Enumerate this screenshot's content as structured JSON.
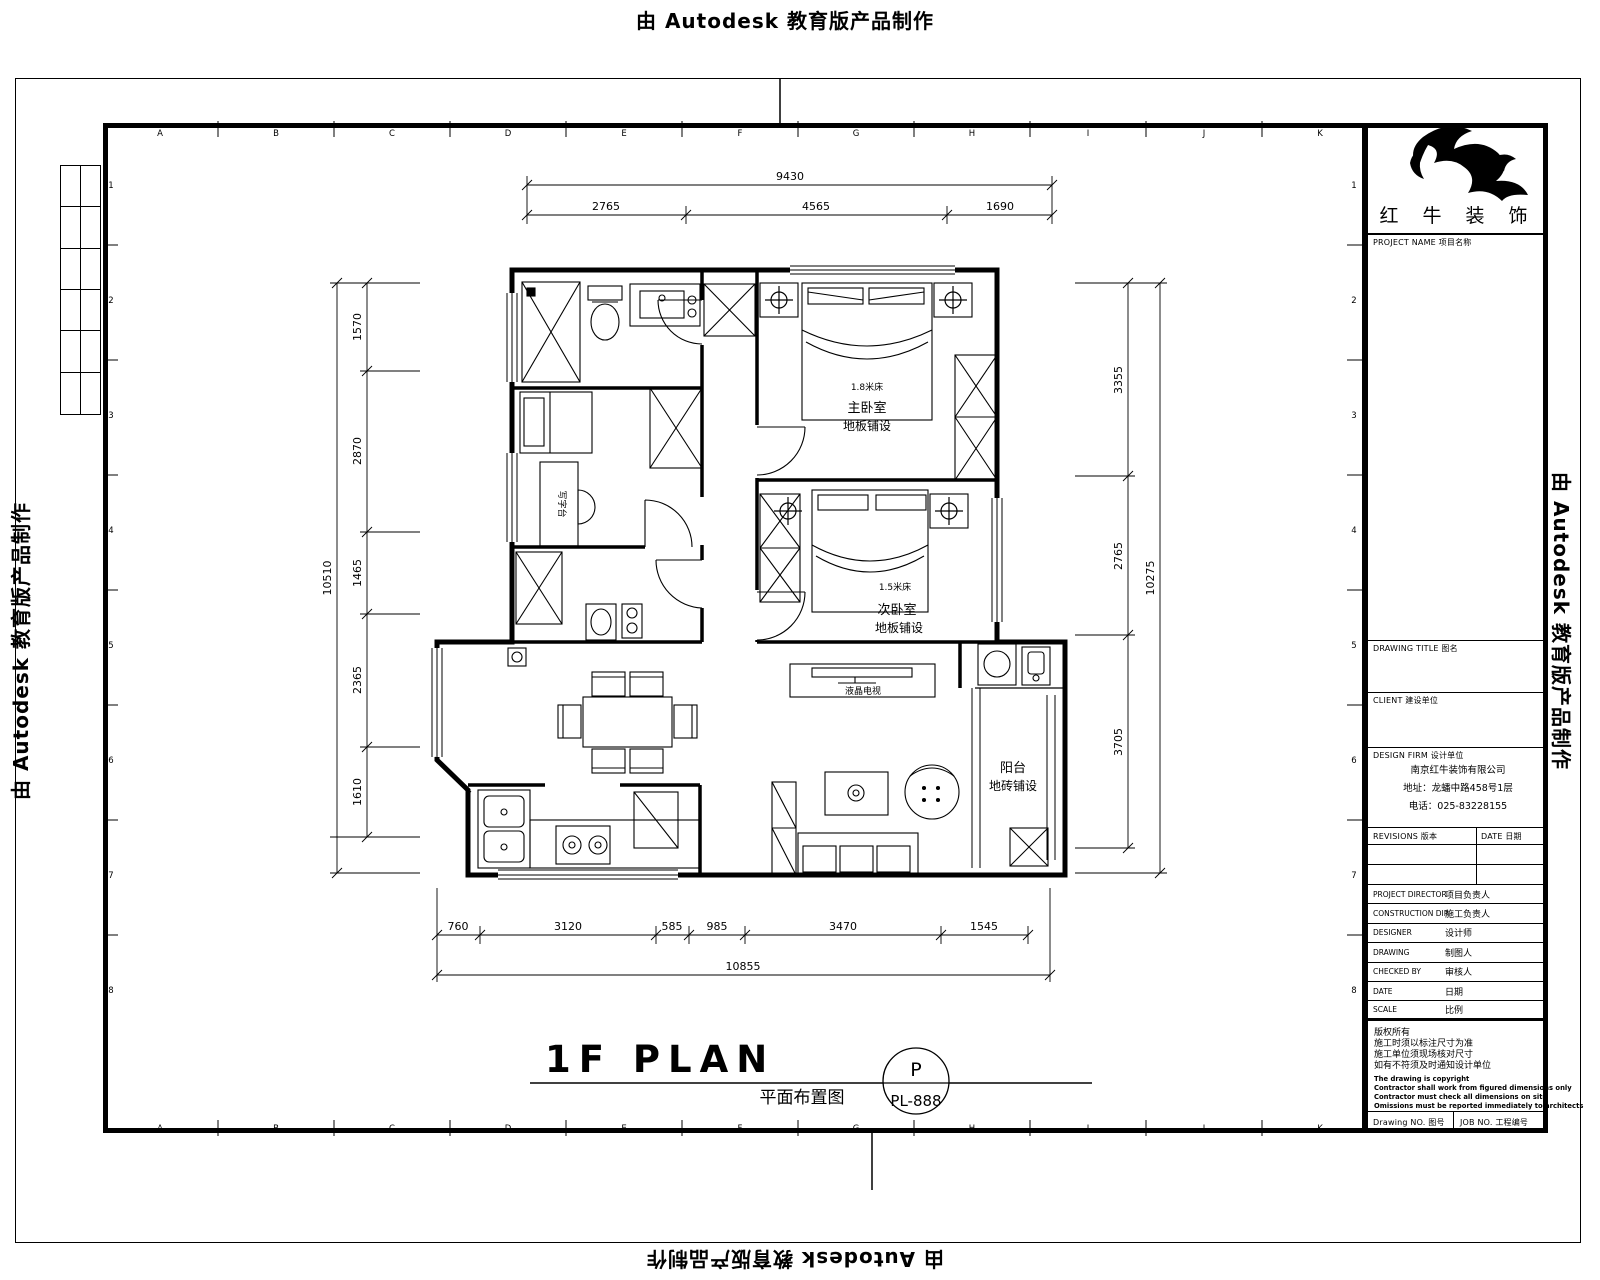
{
  "banner": {
    "text": "由 Autodesk 教育版产品制作"
  },
  "title": {
    "main": "1F PLAN",
    "subtitle": "平面布置图",
    "stamp_letter": "P",
    "stamp_number": "PL-888"
  },
  "grid": {
    "letters": [
      "A",
      "B",
      "C",
      "D",
      "E",
      "F",
      "G",
      "H",
      "I",
      "J",
      "K"
    ],
    "numbers": [
      "1",
      "2",
      "3",
      "4",
      "5",
      "6",
      "7",
      "8"
    ]
  },
  "dimensions": {
    "top": {
      "total": "9430",
      "segments": [
        "2765",
        "4565",
        "1690"
      ]
    },
    "left": {
      "total": "10510",
      "segments": [
        "1570",
        "2870",
        "1465",
        "2365",
        "1610"
      ]
    },
    "right": {
      "total": "10275",
      "segments": [
        "3355",
        "2765",
        "3705"
      ]
    },
    "bottom": {
      "total": "10855",
      "segments": [
        "760",
        "3120",
        "585",
        "985",
        "3470",
        "1545"
      ]
    }
  },
  "rooms": {
    "master": {
      "bed": "1.8米床",
      "name": "主卧室",
      "finish": "地板铺设"
    },
    "second": {
      "bed": "1.5米床",
      "name": "次卧室",
      "finish": "地板铺设"
    },
    "balcony": {
      "name": "阳台",
      "finish": "地砖铺设"
    },
    "living_tv": "液晶电视",
    "desk": "写字台"
  },
  "title_block": {
    "logo_text": "红 牛 装 饰",
    "project_name_label": "PROJECT NAME 项目名称",
    "drawing_title_label": "DRAWING TITLE 图名",
    "client_label": "CLIENT 建设单位",
    "design_firm_label": "DESIGN FIRM 设计单位",
    "firm_lines": [
      "南京红牛装饰有限公司",
      "地址：龙蟠中路458号1层",
      "电话：025-83228155"
    ],
    "revisions_label": "REVISIONS 版本",
    "date_col_label": "DATE 日期",
    "rows": [
      {
        "label": "PROJECT DIRECTOR",
        "cn": "项目负责人"
      },
      {
        "label": "CONSTRUCTION DIR.",
        "cn": "施工负责人"
      },
      {
        "label": "DESIGNER",
        "cn": "设计师"
      },
      {
        "label": "DRAWING",
        "cn": "制图人"
      },
      {
        "label": "CHECKED BY",
        "cn": "审核人"
      },
      {
        "label": "DATE",
        "cn": "日期"
      },
      {
        "label": "SCALE",
        "cn": "比例"
      }
    ],
    "notes_cn": [
      "版权所有",
      "施工时须以标注尺寸为准",
      "施工单位须现场核对尺寸",
      "如有不符须及时通知设计单位"
    ],
    "notes_en": [
      "The drawing is copyright",
      "Contractor shall work from figured dimensions only",
      "Contractor must check all dimensions on site",
      "Omissions must be reported immediately to architects"
    ],
    "drawing_no_label": "Drawing NO. 图号",
    "job_no_label": "JOB NO. 工程编号"
  }
}
